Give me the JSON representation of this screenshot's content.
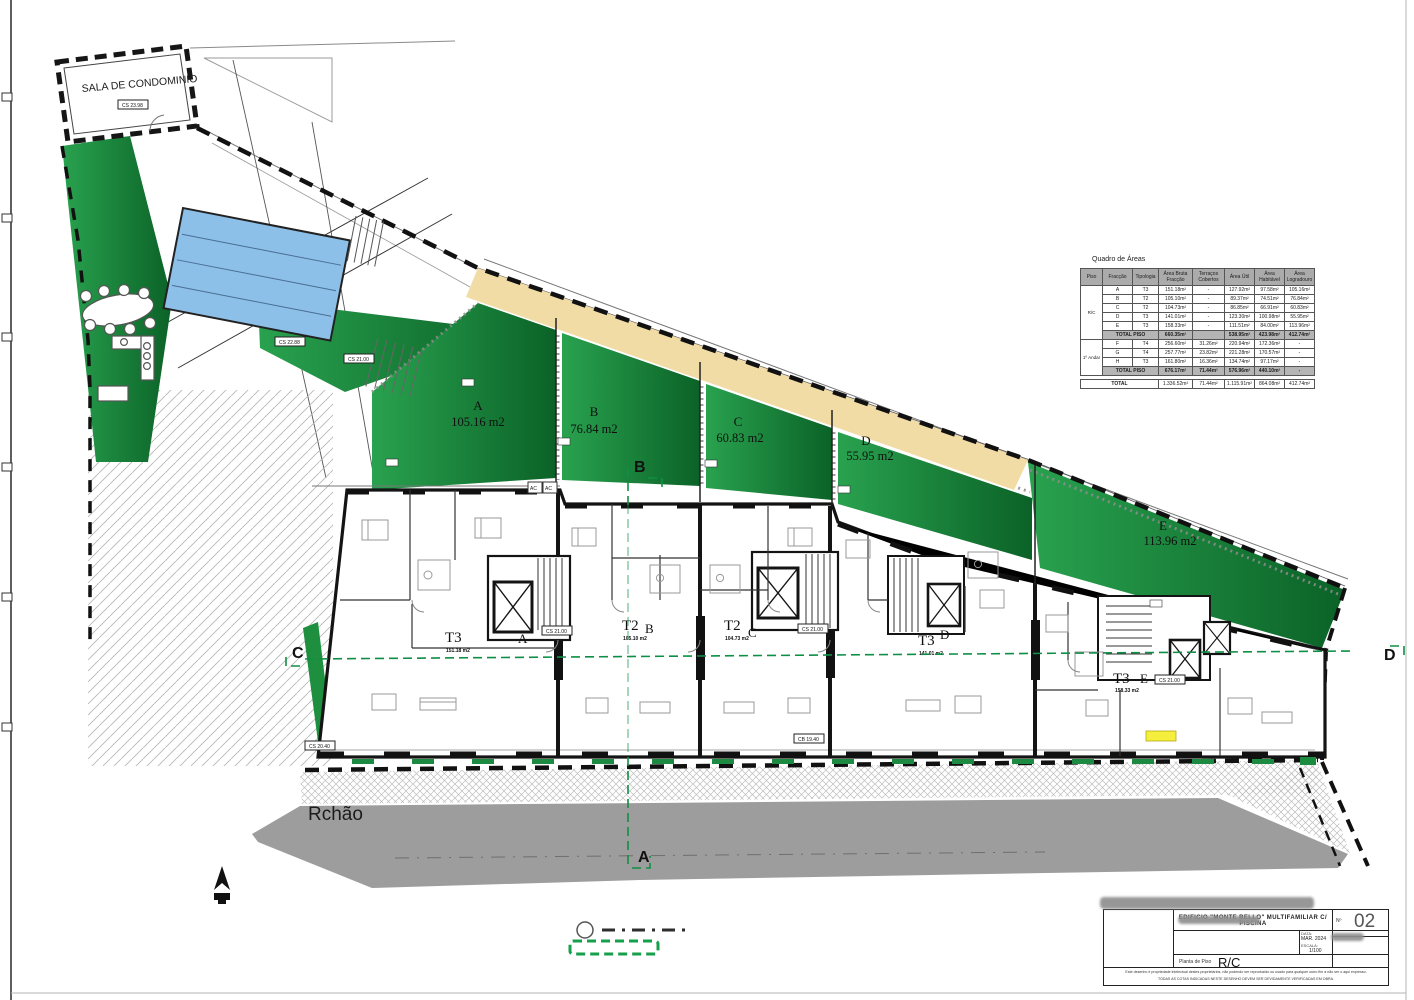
{
  "sheet": {
    "street_label": "Rchão",
    "condo_room": "SALA DE CONDOMINIO",
    "ac_label": "AC",
    "section_markers": {
      "top": "B",
      "bottom": "A",
      "left": "C",
      "right": "D"
    },
    "level_badges": {
      "sala": "CS 23.98",
      "pool": "CS 22.88",
      "walkway": "CS 21.00",
      "unit_a": "CS 21.00",
      "unit_c": "CS 21.00",
      "unit_e": "CS 21.00",
      "left_edge": "CS 20.40",
      "street": "CB 19.40"
    },
    "garden_plots": [
      {
        "letter": "A",
        "area": "105.16 m2"
      },
      {
        "letter": "B",
        "area": "76.84 m2"
      },
      {
        "letter": "C",
        "area": "60.83 m2"
      },
      {
        "letter": "D",
        "area": "55.95 m2"
      },
      {
        "letter": "E",
        "area": "113.96 m2"
      }
    ],
    "units": [
      {
        "type": "T3",
        "letter": "A",
        "area": "151.18 m2"
      },
      {
        "type": "T2",
        "letter": "B",
        "area": "105.10 m2"
      },
      {
        "type": "T2",
        "letter": "C",
        "area": "104.73 m2"
      },
      {
        "type": "T3",
        "letter": "D",
        "area": "141.01 m2"
      },
      {
        "type": "T3",
        "letter": "E",
        "area": "158.33 m2"
      }
    ],
    "colors": {
      "garden_green": "#1d8f3f",
      "garden_green_dark": "#0b6227",
      "pool_blue": "#8cc0e8",
      "sand": "#f1dca6",
      "road_gray": "#9d9d9d",
      "section_green": "#0f8f45",
      "highlight_yellow": "#f5ee3d"
    }
  },
  "areas_table": {
    "title": "Quadro de Áreas",
    "headers": [
      "Piso",
      "Fracção",
      "Tipologia",
      "Área Bruta Fracção",
      "Terraços Cobertos",
      "Área Útil",
      "Área Habitável",
      "Área Logradouro"
    ],
    "floors": [
      {
        "piso": "R/C",
        "rows": [
          [
            "A",
            "T3",
            "151.18m²",
            "-",
            "127.92m²",
            "97.58m²",
            "105.16m²"
          ],
          [
            "B",
            "T2",
            "105.10m²",
            "-",
            "89.37m²",
            "74.51m²",
            "76.84m²"
          ],
          [
            "C",
            "T2",
            "104.73m²",
            "-",
            "86.85m²",
            "66.91m²",
            "60.83m²"
          ],
          [
            "D",
            "T3",
            "141.01m²",
            "-",
            "123.30m²",
            "100.98m²",
            "55.95m²"
          ],
          [
            "E",
            "T3",
            "158.33m²",
            "-",
            "111.51m²",
            "84.00m²",
            "113.96m²"
          ]
        ],
        "total_label": "TOTAL PISO",
        "total": [
          "660.35m²",
          "",
          "538.95m²",
          "423.98m²",
          "412.74m²"
        ]
      },
      {
        "piso": "1º Andar",
        "rows": [
          [
            "F",
            "T4",
            "256.60m²",
            "31.26m²",
            "220.94m²",
            "172.36m²",
            "-"
          ],
          [
            "G",
            "T4",
            "257.77m²",
            "23.82m²",
            "221.28m²",
            "170.57m²",
            "-"
          ],
          [
            "H",
            "T3",
            "161.80m²",
            "16.36m²",
            "134.74m²",
            "97.17m²",
            "-"
          ]
        ],
        "total_label": "TOTAL PISO",
        "total": [
          "676.17m²",
          "71.44m²",
          "576.96m²",
          "440.10m²",
          "-"
        ]
      }
    ],
    "grand_total_label": "TOTAL",
    "grand_total": [
      "1.336.52m²",
      "71.44m²",
      "1.115.91m²",
      "864.08m²",
      "412.74m²"
    ]
  },
  "title_block": {
    "project": "EDIFICIO \"MONTE BELLO\" MULTIFAMILIAR C/ PISCINA",
    "number_label": "Nº",
    "number": "02",
    "date_label": "DATA:",
    "date": "MAR. 2024",
    "scale_label": "ESCALA:",
    "scale": "1/100",
    "drawing_label": "Planta de Piso",
    "drawing": "R/C",
    "disclaimer_line1": "Este desenho é propriedade intelectual destes proprietários, não podendo ser reproduzido ou usado para qualquer outro fim a não ser o aqui expresso.",
    "disclaimer_line2": "TODAS AS COTAS INDICADAS NESTE DESENHO DEVEM SER DEVIDAMENTE VERIFICADAS EM OBRA."
  }
}
